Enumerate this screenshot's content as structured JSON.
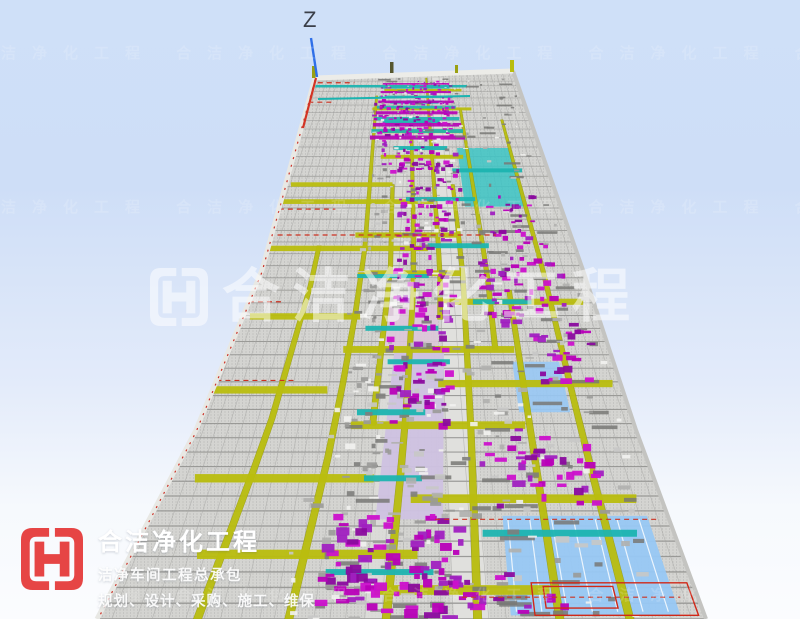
{
  "viewport": {
    "description": "3D BIM perspective viewport of a cleanroom MEP model",
    "axis_gizmo": {
      "label": "Z"
    },
    "model_palette": {
      "slab": "#d4d4d1",
      "dots": "#a4a4a2",
      "corridor": "#e0e0dd",
      "beam_olive": "#b9bd0e",
      "beam_olive_edge": "#8e9206",
      "pipe_teal": "#1cb4b0",
      "duct_magenta": "#b400b4",
      "panel_blue": "#98c8f4",
      "panel_lavender": "#cfc2e2",
      "panel_pink": "#dcc6d8",
      "line_red": "#cc3222",
      "duct_gray": "#787876",
      "floor_line": "#90908e",
      "edge_light": "#e8e8e4",
      "edge_shadow": "#c4c4c1",
      "axis_blue": "#2f6fe8",
      "axis_red": "#d23424"
    }
  },
  "watermark": {
    "text": "合洁净化工程",
    "color": "rgba(255,255,255,0.52)",
    "tile_repeat": 7
  },
  "logo": {
    "title": "合洁净化工程",
    "subtitle": "洁净车间工程总承包",
    "tagline": "规划、设计、采购、施工、维保",
    "brand_color": "#e64545"
  }
}
